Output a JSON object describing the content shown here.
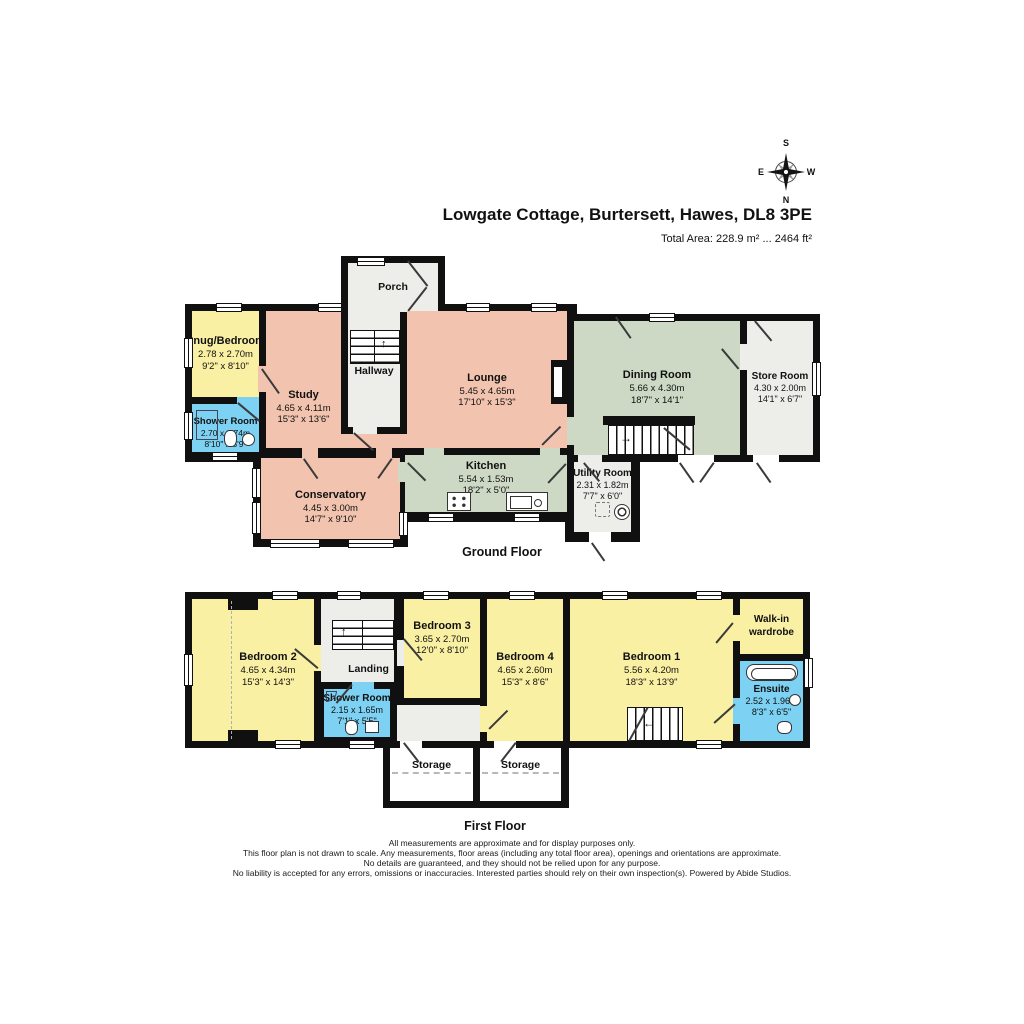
{
  "header": {
    "title": "Lowgate Cottage, Burtersett, Hawes, DL8 3PE",
    "total_area": "Total Area: 228.9 m² ... 2464 ft²"
  },
  "compass": {
    "top": "S",
    "left": "E",
    "right": "W",
    "bottom": "N"
  },
  "icons": {
    "arrow_up": "↑",
    "arrow_right": "→",
    "arrow_left": "←"
  },
  "ground_floor": {
    "label": "Ground Floor",
    "rooms": {
      "porch": {
        "name": "Porch"
      },
      "snug_bedroom": {
        "name": "Snug/Bedroom",
        "metric": "2.78 x 2.70m",
        "imperial": "9'2\" x 8'10\""
      },
      "shower_room": {
        "name": "Shower Room",
        "metric": "2.70 x 1.74m",
        "imperial": "8'10\" x 5'9\""
      },
      "study": {
        "name": "Study",
        "metric": "4.65 x 4.11m",
        "imperial": "15'3\" x 13'6\""
      },
      "hallway": {
        "name": "Hallway"
      },
      "lounge": {
        "name": "Lounge",
        "metric": "5.45 x 4.65m",
        "imperial": "17'10\" x 15'3\""
      },
      "dining_room": {
        "name": "Dining Room",
        "metric": "5.66 x 4.30m",
        "imperial": "18'7\" x 14'1\""
      },
      "store_room": {
        "name": "Store Room",
        "metric": "4.30 x 2.00m",
        "imperial": "14'1\" x 6'7\""
      },
      "kitchen": {
        "name": "Kitchen",
        "metric": "5.54 x 1.53m",
        "imperial": "18'2\" x 5'0\""
      },
      "utility_room": {
        "name": "Utility Room",
        "metric": "2.31 x 1.82m",
        "imperial": "7'7\" x 6'0\""
      },
      "conservatory": {
        "name": "Conservatory",
        "metric": "4.45 x 3.00m",
        "imperial": "14'7\" x 9'10\""
      }
    }
  },
  "first_floor": {
    "label": "First Floor",
    "rooms": {
      "bedroom_2": {
        "name": "Bedroom 2",
        "metric": "4.65 x 4.34m",
        "imperial": "15'3\" x 14'3\""
      },
      "landing": {
        "name": "Landing"
      },
      "shower_room": {
        "name": "Shower Room",
        "metric": "2.15 x 1.65m",
        "imperial": "7'1\" x 5'5\""
      },
      "bedroom_3": {
        "name": "Bedroom 3",
        "metric": "3.65 x 2.70m",
        "imperial": "12'0\" x 8'10\""
      },
      "bedroom_4": {
        "name": "Bedroom 4",
        "metric": "4.65 x 2.60m",
        "imperial": "15'3\" x 8'6\""
      },
      "bedroom_1": {
        "name": "Bedroom 1",
        "metric": "5.56 x 4.20m",
        "imperial": "18'3\" x 13'9\""
      },
      "walk_in_wardrobe": {
        "name": "Walk-in wardrobe"
      },
      "ensuite": {
        "name": "Ensuite",
        "metric": "2.52 x 1.96m",
        "imperial": "8'3\" x 6'5\""
      },
      "storage_1": {
        "name": "Storage"
      },
      "storage_2": {
        "name": "Storage"
      }
    }
  },
  "footer": {
    "lines": [
      "All measurements are approximate and for display purposes only.",
      "This floor plan is not drawn to scale. Any measurements, floor areas (including any total floor area), openings and orientations are approximate.",
      "No details are guaranteed, and they should not be relied upon for any purpose.",
      "No liability is accepted for any errors, omissions or inaccuracies. Interested parties should rely on their own inspection(s). Powered by Abide Studios."
    ]
  },
  "colors": {
    "wall": "#101010",
    "lounge_salmon": "#f2c4af",
    "bedroom_yellow": "#faf0a4",
    "dining_green": "#cdd9c4",
    "bath_blue": "#7dd1f3",
    "hall_gray": "#ededea"
  }
}
